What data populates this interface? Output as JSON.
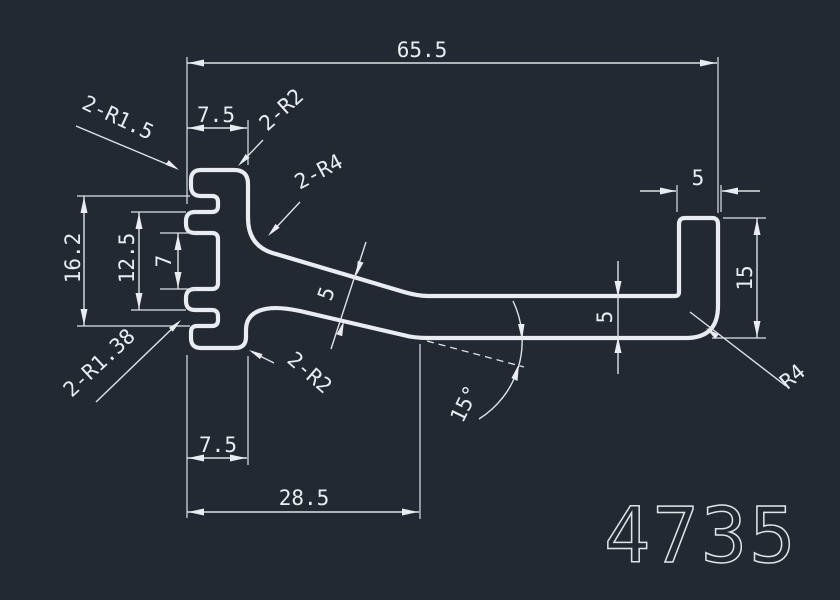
{
  "drawing": {
    "part_number": "4735",
    "colors": {
      "background": "#232933",
      "line": "#e9edf2"
    },
    "dimensions": {
      "total_width": "65.5",
      "top_tooth_width": "7.5",
      "head_height": "16.2",
      "inner_height": "12.5",
      "slot_height": "7",
      "bottom_tooth_width": "7.5",
      "bottom_width": "28.5",
      "arm_angle": "15°",
      "arm_thickness_slant": "5",
      "arm_thickness": "5",
      "flange_width": "5",
      "flange_height": "15"
    },
    "radius_labels": {
      "top_left": "2-R1.5",
      "top_right": "2-R2",
      "arm_fillet": "2-R4",
      "bottom_left": "2-R1.38",
      "bottom_corner": "2-R2",
      "bottom_right": "R4"
    }
  }
}
